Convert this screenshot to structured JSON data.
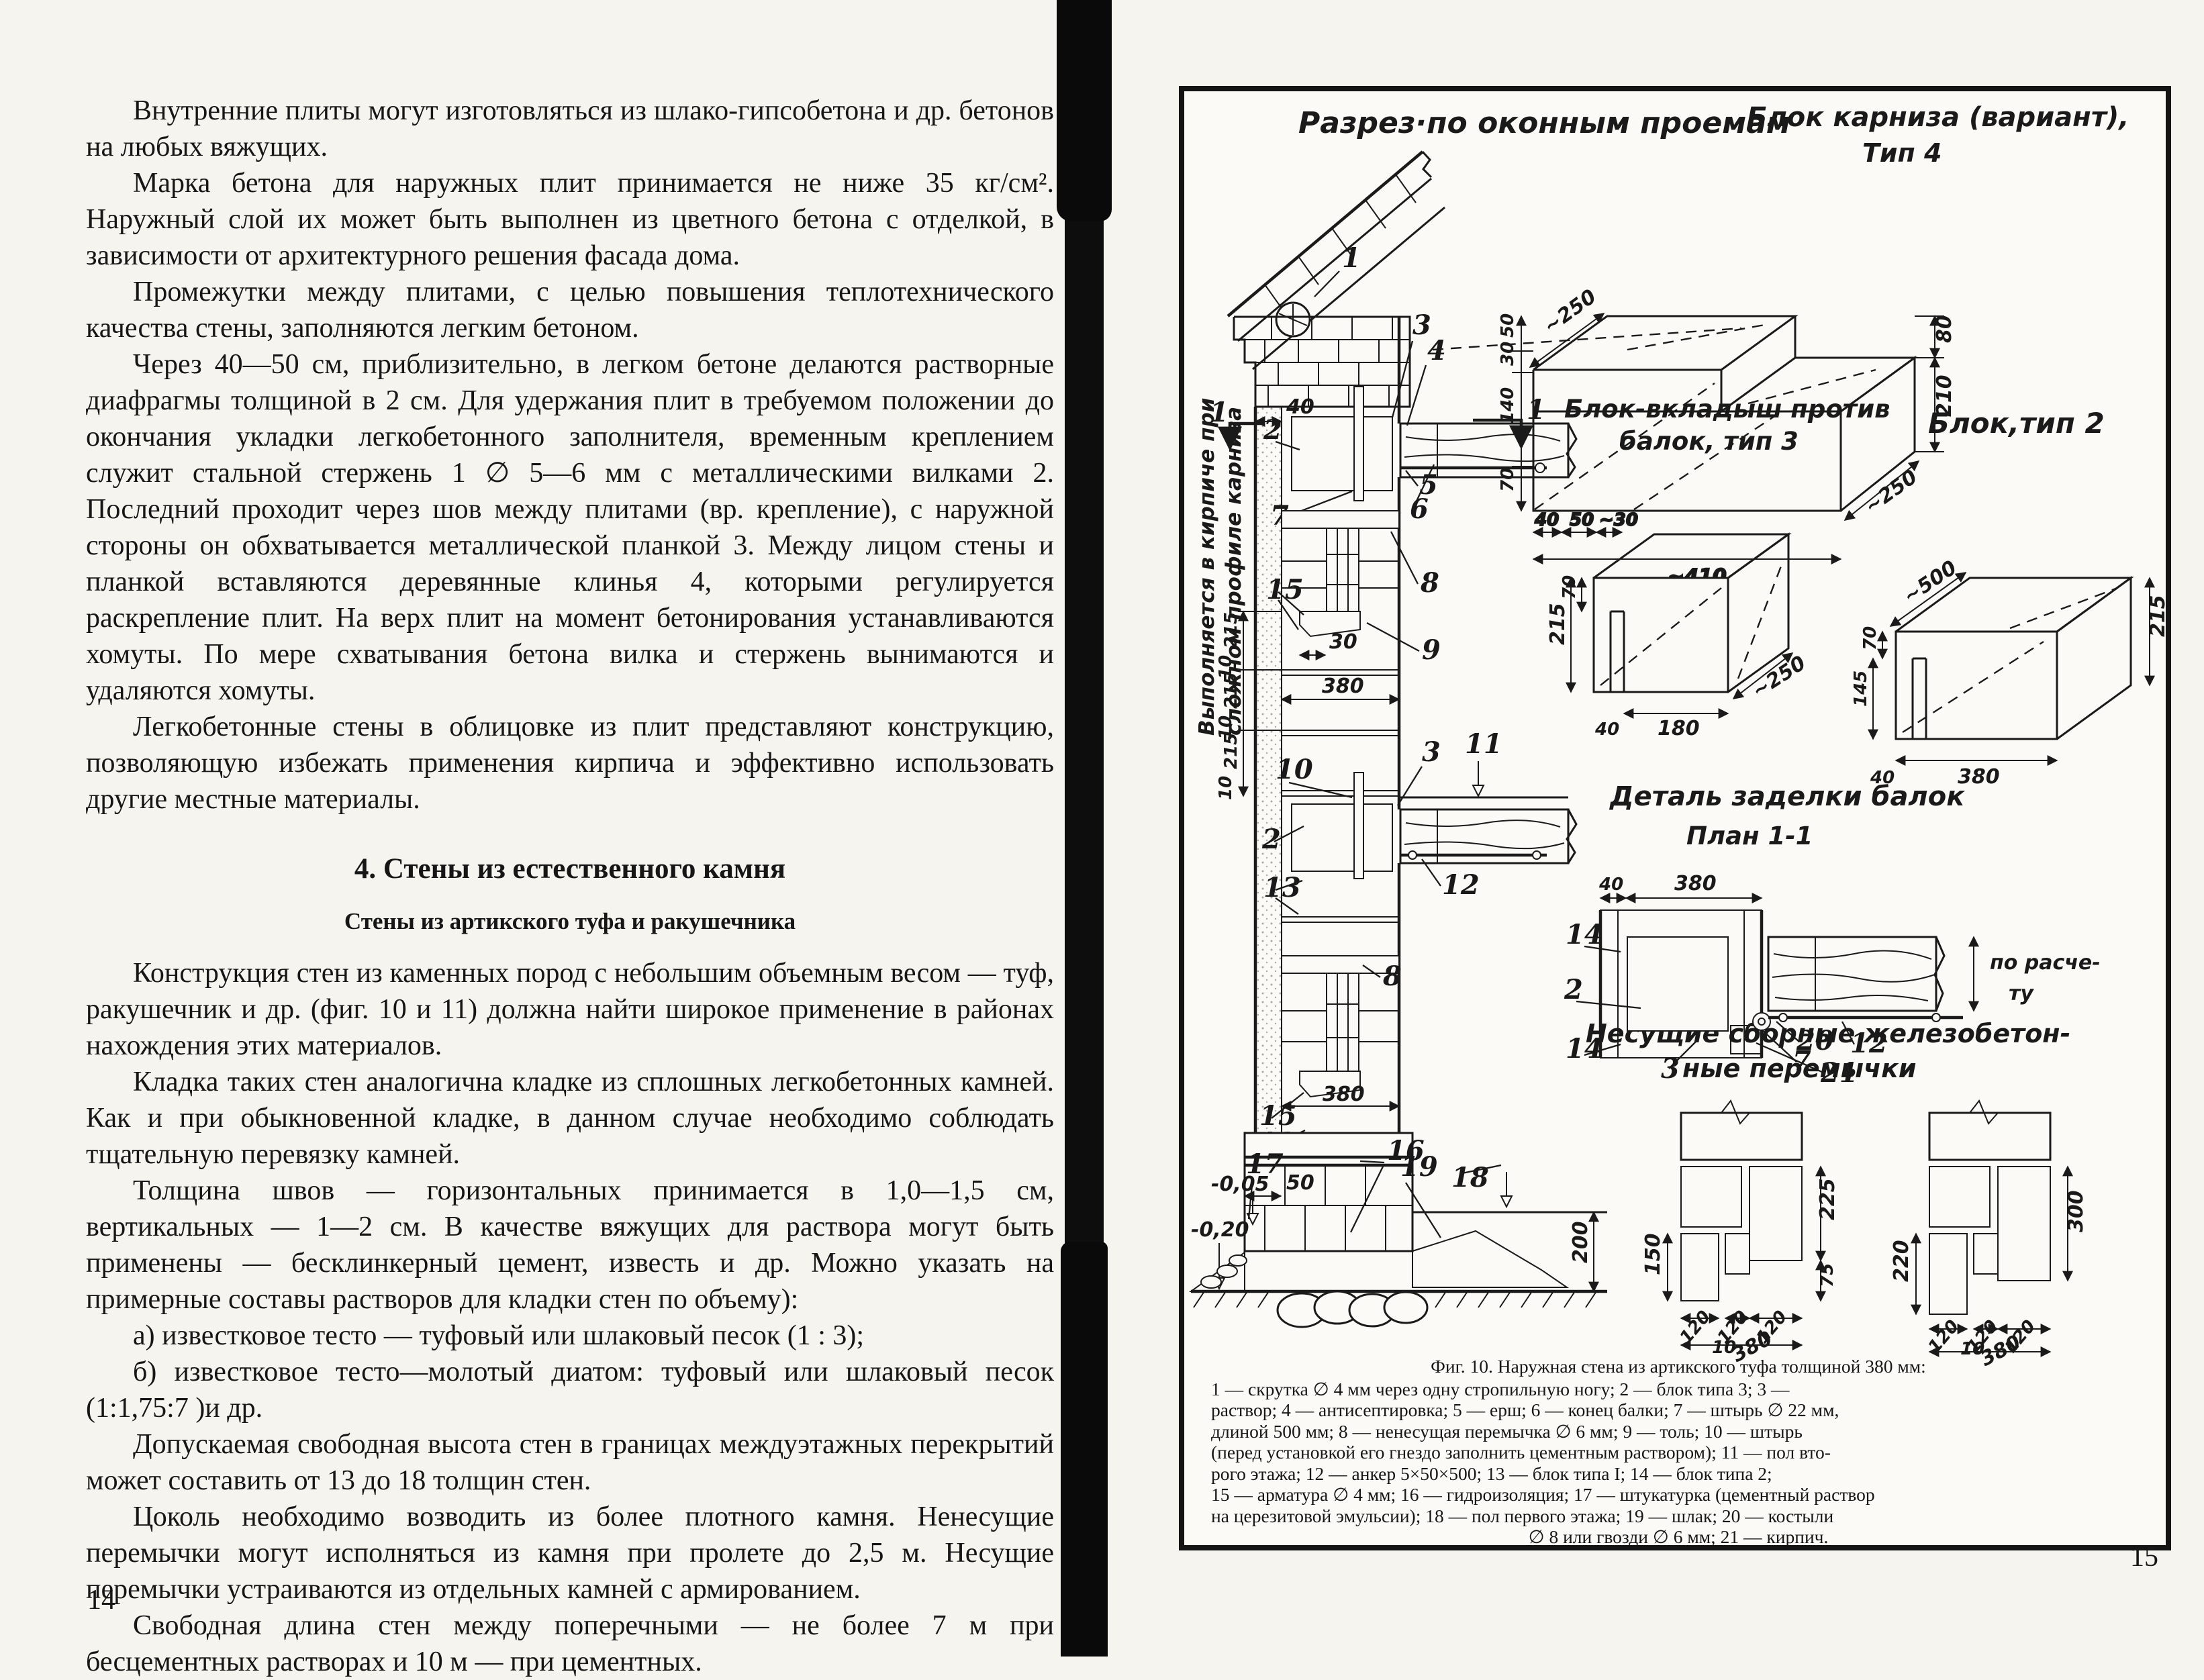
{
  "left_page": {
    "page_number": "14",
    "heading": "4. Стены из естественного камня",
    "subheading": "Стены из артикского туфа и ракушечника",
    "paragraphs": [
      "Внутренние плиты могут изготовляться из шлако-гипсобетона и др. бетонов на любых вяжущих.",
      "Марка бетона для наружных плит принимается не ниже 35 кг/см². Наружный слой их может быть выполнен из цветного бетона с отделкой, в зависимости от архитектурного решения фасада дома.",
      "Промежутки между плитами, с целью повышения теплотехнического качества стены, заполняются легким бетоном.",
      "Через 40—50 см, приблизительно, в легком бетоне делаются растворные диафрагмы толщиной в 2 см. Для удержания плит в требуемом положении до окончания укладки легкобетонного заполнителя, временным креплением служит стальной стержень 1 ∅ 5—6 мм с металлическими вилками 2. Последний проходит через шов между плитами (вр. крепление), с наружной стороны он обхватывается металлической планкой 3. Между лицом стены и планкой вставляются деревянные клинья 4, которыми регулируется раскрепление плит. На верх плит на момент бетонирования устанавливаются хомуты. По мере схватывания бетона вилка и стержень вынимаются и удаляются хомуты.",
      "Легкобетонные стены в облицовке из плит представляют конструкцию, позволяющую избежать применения кирпича и эффективно использовать другие местные материалы.",
      "Конструкция стен из каменных пород с небольшим объемным весом — туф, ракушечник и др. (фиг. 10 и 11) должна найти широкое применение в районах нахождения этих материалов.",
      "Кладка таких стен аналогична кладке из сплошных легкобетонных камней. Как и при обыкновенной кладке, в данном случае необходимо соблюдать тщательную перевязку камней.",
      "Толщина швов — горизонтальных принимается в 1,0—1,5 см, вертикальных — 1—2 см. В качестве вяжущих для раствора могут быть применены — бесклинкерный цемент, известь и др. Можно указать на примерные составы растворов для кладки стен по объему):",
      "а) известковое тесто — туфовый или шлаковый песок (1 : 3);",
      "б) известковое тесто—молотый диатом: туфовый или шлаковый песок (1:1,75:7 )и др.",
      "Допускаемая свободная высота стен в границах междуэтажных перекрытий может составить от 13 до 18 толщин стен.",
      "Цоколь необходимо возводить из более плотного камня. Ненесущие перемычки могут исполняться из камня при пролете до 2,5 м. Несущие перемычки устраиваются из отдельных камней с армированием.",
      "Свободная длина стен между поперечными — не более 7 м при бесцементных растворах и 10 м — при цементных."
    ]
  },
  "right_page": {
    "page_number": "15",
    "titles": {
      "section": "Разрез·по оконным проемам",
      "sidenote1": "Выполняется в кирпиче при",
      "sidenote2": "сложном профиле карниза",
      "cornice1": "Блок карниза (вариант),",
      "cornice2": "Тип 4",
      "block3a": "Блок-вкладыш против",
      "block3b": "балок, тип 3",
      "block2": "Блок,тип 2",
      "detail1": "Деталь заделки балок",
      "detail2": "План 1-1",
      "lintels1": "Несущие сборные железобетон-",
      "lintels2": "ные перемычки"
    },
    "wall": {
      "n1": "1",
      "n2": "2",
      "n3": "3",
      "n4": "4",
      "n5": "5",
      "n6": "6",
      "n7": "7",
      "n8": "8",
      "n9": "9",
      "n10": "10",
      "n11": "11",
      "n12": "12",
      "n13": "13",
      "n15": "15",
      "n16": "16",
      "n17": "17",
      "n18": "18",
      "n19": "19",
      "d40": "40",
      "d30": "30",
      "d50": "50",
      "d215": "215",
      "d10": "10",
      "d380": "380",
      "d200": "200",
      "lvl05": "-0,05",
      "lvl20": "-0,20"
    },
    "cornice": {
      "d250": "~250",
      "d50": "50",
      "d30": "30",
      "d140": "140",
      "d70": "70",
      "d40": "40",
      "d30b": "~30",
      "d410": "~410",
      "d80": "80",
      "d210": "210"
    },
    "block3": {
      "d70": "70",
      "d215": "215",
      "d250": "~250",
      "d180": "180",
      "d40": "40"
    },
    "block2": {
      "d500": "~500",
      "d215": "215",
      "d70": "70",
      "d145": "145",
      "d380": "380",
      "d40": "40"
    },
    "detail": {
      "d40": "40",
      "d380": "380",
      "n14": "14",
      "n2": "2",
      "n3": "3",
      "n20": "20",
      "n7": "7",
      "n21": "21",
      "n12": "12",
      "note1": "по расче-",
      "note2": "ту"
    },
    "lintels": {
      "d150": "150",
      "d225": "225",
      "d75": "75",
      "d120": "120",
      "d10": "10",
      "d380": "380",
      "d220": "220",
      "d300": "300"
    },
    "caption": [
      "Фиг. 10. Наружная стена из артикского туфа толщиной 380 мм:",
      "1 — скрутка ∅ 4 мм через одну стропильную ногу; 2 — блок типа 3; 3 —",
      "раствор; 4 — антисептировка; 5 — ерш; 6 — конец балки; 7 — штырь ∅ 22 мм,",
      "длиной 500 мм; 8 — ненесущая перемычка ∅ 6 мм; 9 — толь; 10 — штырь",
      "(перед установкой его гнездо заполнить цементным раствором); 11 — пол вто-",
      "рого этажа; 12 — анкер 5×50×500; 13 — блок типа I; 14 — блок типа 2;",
      "15 — арматура ∅ 4 мм; 16 — гидроизоляция; 17 — штукатурка (цементный раствор",
      "на церезитовой эмульсии); 18 — пол первого этажа; 19 — шлак; 20 — костыли",
      "∅ 8 или гвозди ∅ 6 мм; 21 — кирпич."
    ]
  }
}
